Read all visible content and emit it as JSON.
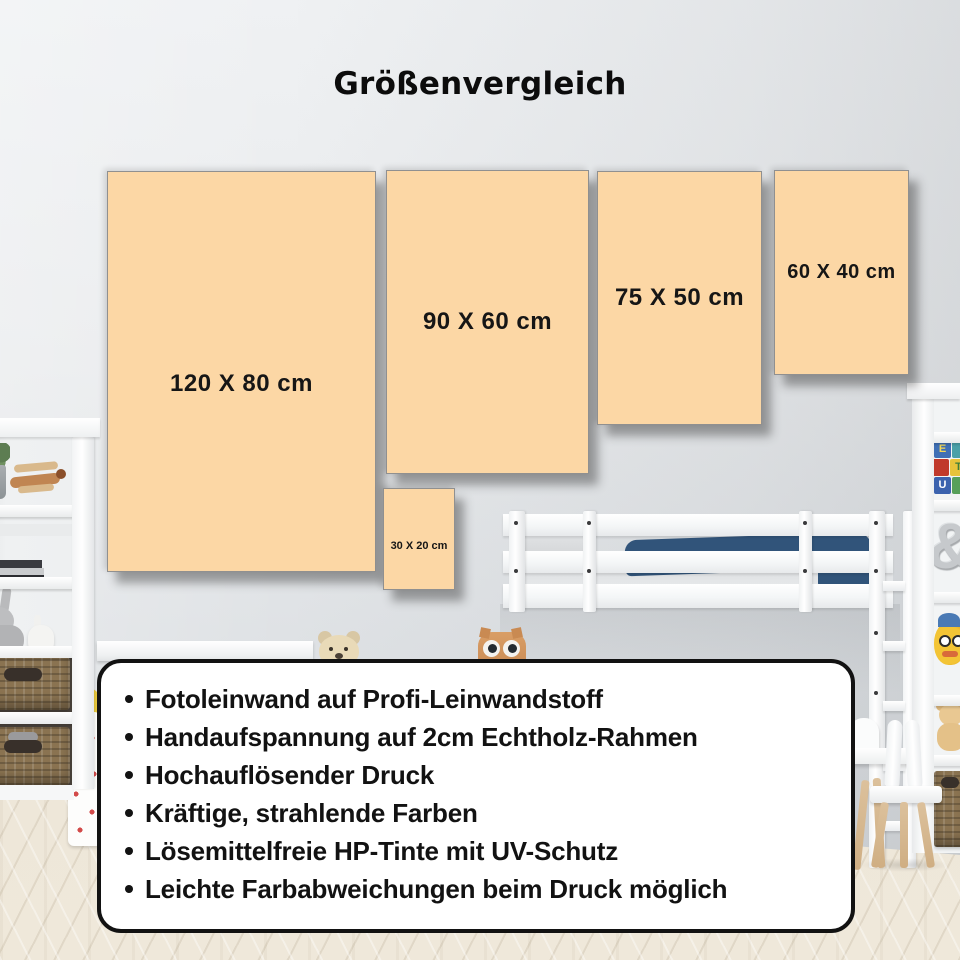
{
  "title": "Größenvergleich",
  "sizes": [
    {
      "label": "120 X 80 cm"
    },
    {
      "label": "90 X 60 cm"
    },
    {
      "label": "75 X 50 cm"
    },
    {
      "label": "60 X 40 cm"
    },
    {
      "label": "30 X 20 cm"
    }
  ],
  "features": [
    "Fotoleinwand auf Profi-Leinwandstoff",
    "Handaufspannung auf 2cm Echtholz-Rahmen",
    "Hochauflösender Druck",
    "Kräftige, strahlende Farben",
    "Lösemittelfreie HP-Tinte mit UV-Schutz",
    "Leichte Farbabweichungen beim Druck möglich"
  ],
  "decor": {
    "alphabet_blocks": [
      "E",
      "T",
      "U"
    ],
    "ampersand": "&"
  },
  "colors": {
    "canvas": "#fcd7a5",
    "canvas_text": "#161616",
    "title_text": "#0c0c0c",
    "card_bg": "#ffffff",
    "card_border": "#121212",
    "card_text": "#121212",
    "blanket": "#31547a",
    "basket": "#8a7351"
  }
}
